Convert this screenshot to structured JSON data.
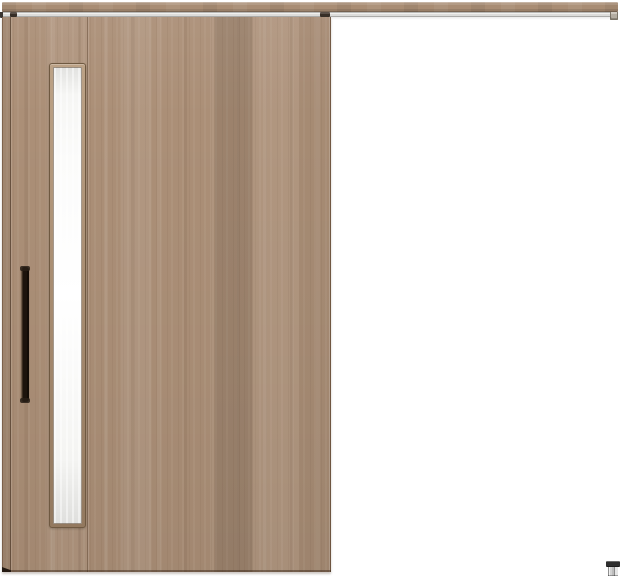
{
  "components": {
    "scene": "sliding-door-product-image",
    "rail": "hanging-rail",
    "track": "door-track",
    "rail_end_cap": "rail-end-cap",
    "door": "sliding-door-panel",
    "glass": "vertical-glass-insert",
    "handle": "door-handle-bar",
    "hanger": "door-hanger-roller",
    "floor_guide": "floor-guide"
  },
  "colors": {
    "bg": "#ffffff",
    "wood_base": "#ab8f77",
    "wood_dark": "#8a7058",
    "wood_light": "#c6b09a",
    "rail_wood": "#a98d74",
    "track_gray": "#dcdcda",
    "track_line": "#aaaaa8",
    "glass_white": "#fbfbfa",
    "glass_edge": "#e2e2e0",
    "frame_outline": "#6f5941",
    "handle_dark": "#1c130c",
    "handle_highlight": "#6e5a48",
    "guide_cap": "#2e2e2e",
    "guide_body": "#d2d2d2",
    "shadow": "rgba(50,33,20,0.45)"
  }
}
